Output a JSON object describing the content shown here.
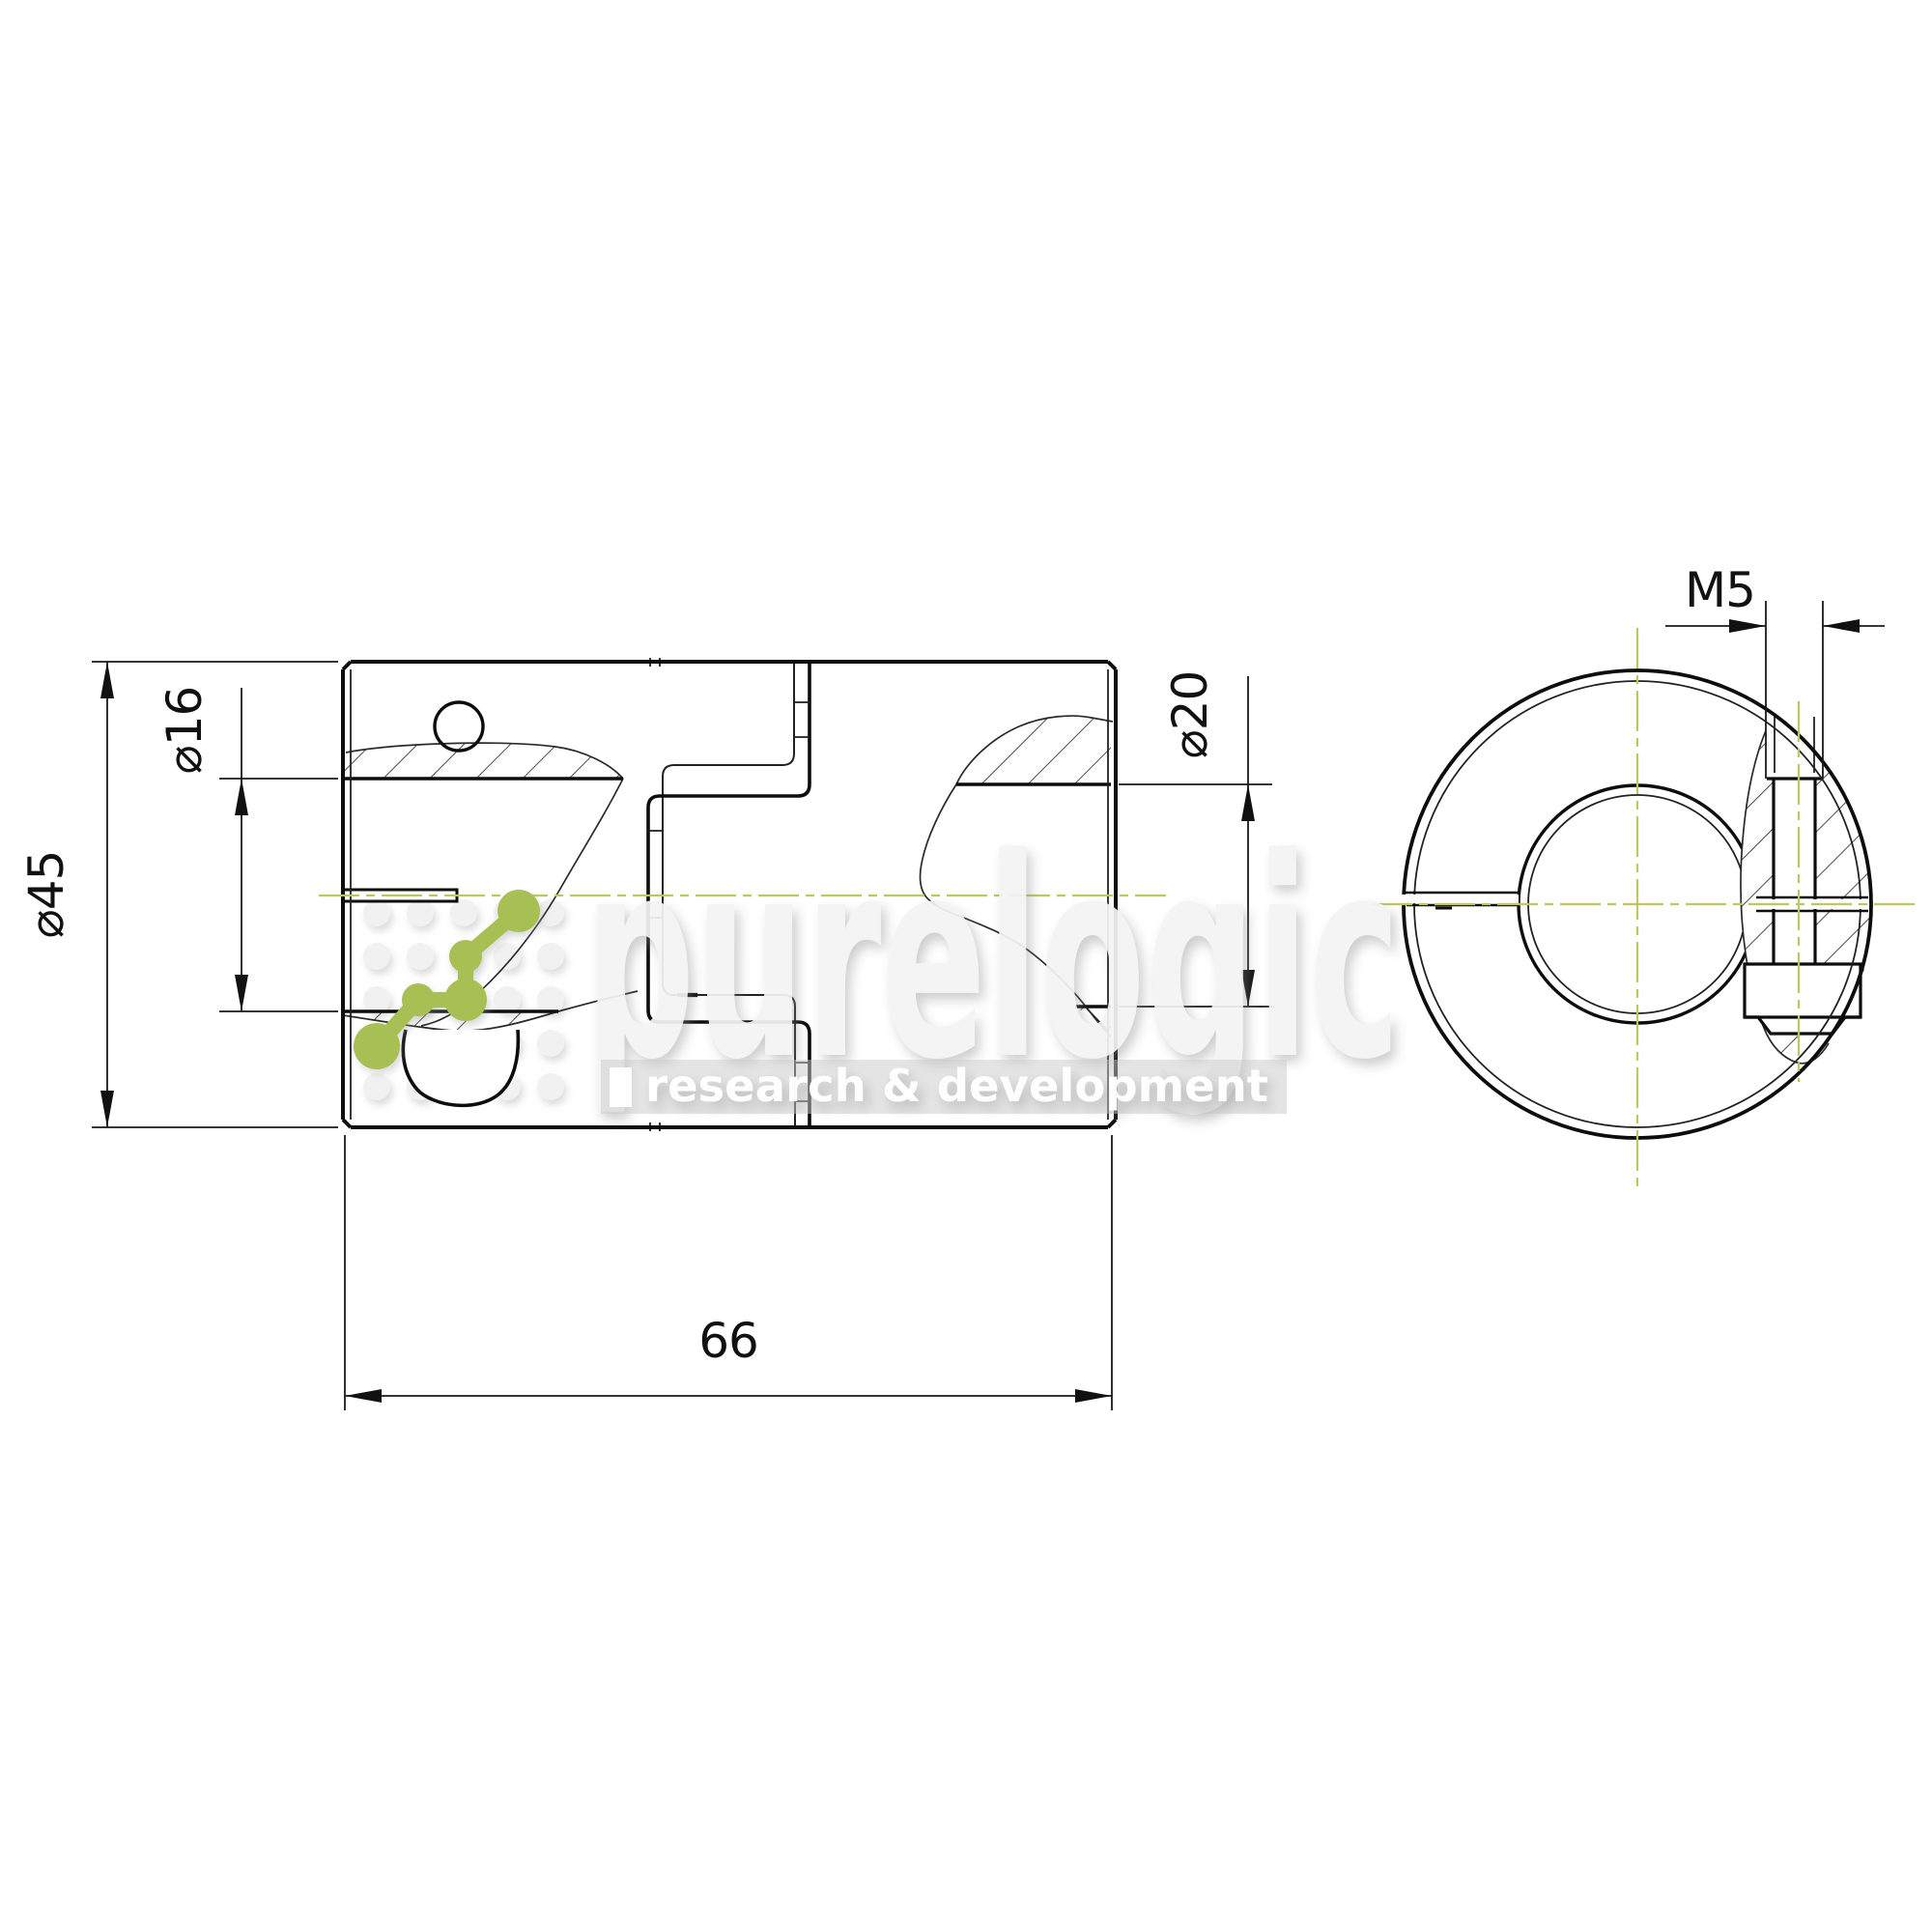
{
  "drawing": {
    "kind": "technical-drawing-2-views",
    "dimensions": {
      "outer_diameter_label": "⌀45",
      "left_bore_label": "⌀16",
      "right_bore_label": "⌀20",
      "length_label": "66",
      "thread_label": "M5"
    },
    "colors": {
      "line": "#111111",
      "centerline_green": "#bdc75f",
      "logo_green": "#a8bf52",
      "watermark_gray": "#f4f4f4"
    },
    "watermark": {
      "brand": "purelogic",
      "tagline": "research & development"
    }
  }
}
